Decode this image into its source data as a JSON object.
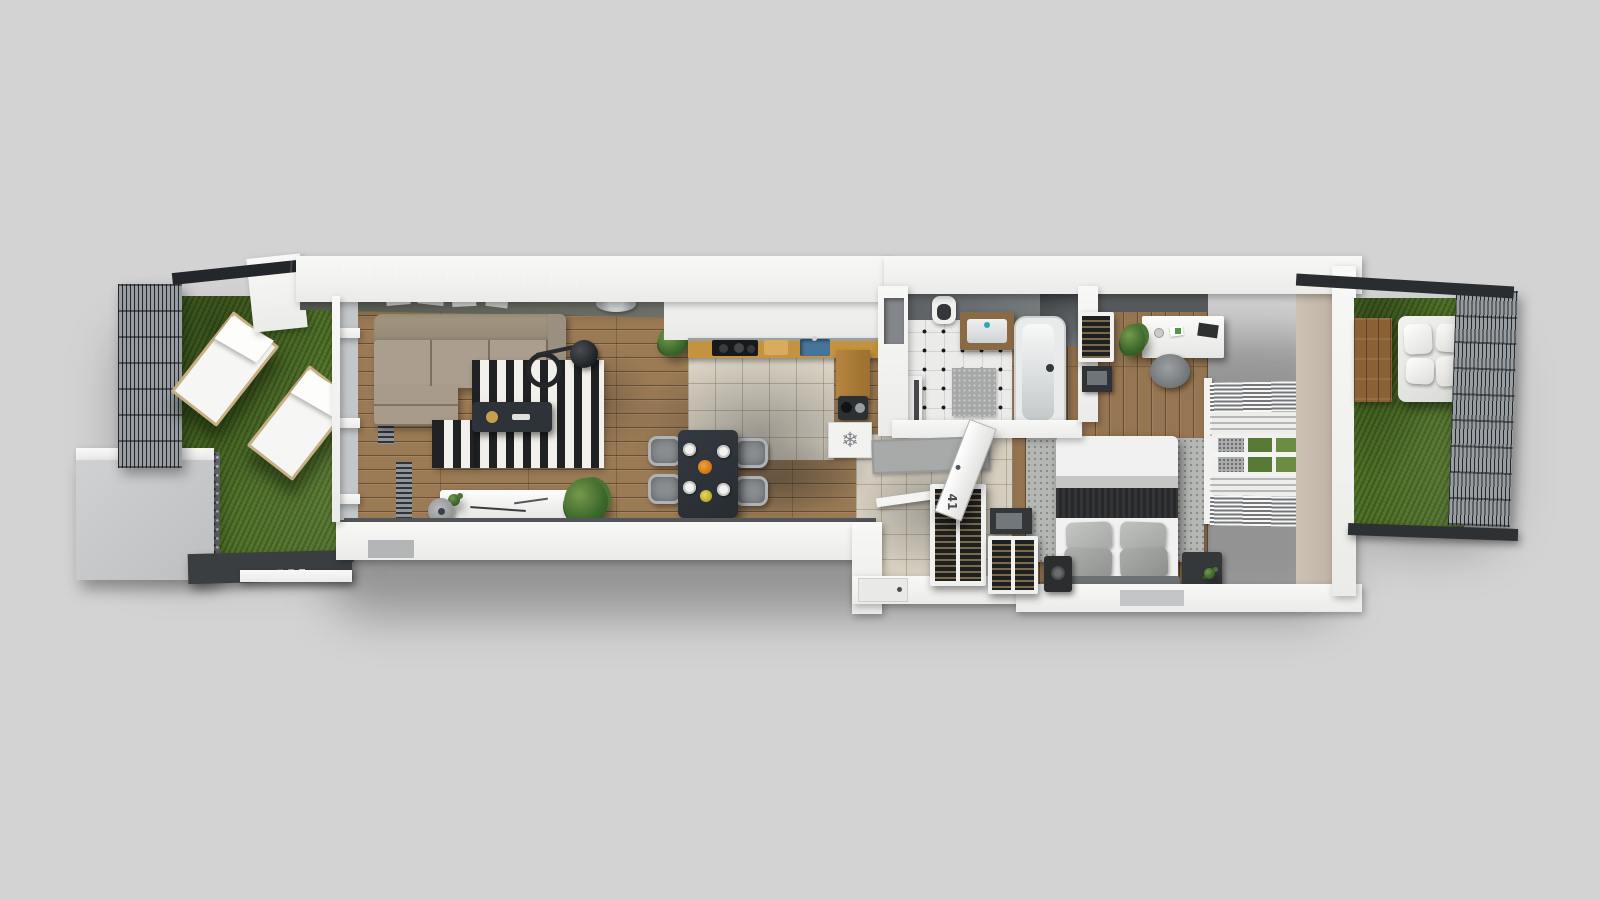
{
  "scene": {
    "type": "3d-apartment-floor-plan-render",
    "door_number": "41",
    "background": "#d3d3d3"
  },
  "icons": {
    "freezer_glyph": "❄",
    "freezer_name": "snowflake-icon"
  },
  "colors": {
    "bg": "#d3d3d3",
    "wall": "#f5f5f4",
    "wood": "#9b7b55",
    "tile_kitchen": "#ddd6c7",
    "tile_hall": "#d6cfc0",
    "tile_bath": "#ebebea",
    "grass": "#4e6f28",
    "rug_black": "#1f2123",
    "rug_white": "#f2f0ea",
    "counter_wood": "#c3933f",
    "sink_blue": "#46759b",
    "table": "#2f353b",
    "chair": "#8b8f92",
    "throw": "#26282a",
    "tan": "#c8bcae",
    "plant": "#3f6b2d",
    "accent_teal": "#2fa6b0",
    "walkway": "#3a3e41"
  },
  "rooms": {
    "left_terrace": {
      "name": "left terrace",
      "features": [
        "grass lawn",
        "two sun loungers",
        "slatted privacy fence",
        "gravel strip",
        "concrete pad",
        "walkway with drain grate",
        "dark canopy overhang"
      ]
    },
    "living_room": {
      "name": "living room",
      "furniture": [
        "corner sofa",
        "black and white striped rug",
        "coffee table",
        "floor lamp",
        "sideboard",
        "pouf",
        "potted plants",
        "radiators",
        "ceiling lamp",
        "wall pictures"
      ]
    },
    "kitchen": {
      "name": "kitchen and dining",
      "furniture": [
        "white cabinets",
        "oak counter with cooktop",
        "cutting board",
        "blue sink",
        "corner wood counter",
        "coffee machine",
        "freezer marked with snowflake",
        "dining table for four",
        "four gray chairs",
        "plates with food"
      ]
    },
    "bathroom": {
      "name": "bathroom",
      "furniture": [
        "wood vanity with basin",
        "toilet",
        "bathtub",
        "shower glass",
        "washing machine",
        "bath mat"
      ],
      "floor": "white tiles with black dot inlays"
    },
    "hallway": {
      "name": "entrance hall",
      "furniture": [
        "gray doormat",
        "open door numbered 41",
        "two wine racks",
        "storage box",
        "speaker"
      ]
    },
    "bedroom": {
      "name": "bedroom",
      "furniture": [
        "double bed with dark throw and gray pillows",
        "gray rug",
        "desk with chair",
        "desk plant",
        "bottle shelf rack",
        "tv cabinet",
        "nightstand",
        "window with venetian blinds"
      ]
    },
    "right_terrace": {
      "name": "right terrace",
      "features": [
        "grass lawn",
        "wood deck",
        "white outdoor lounge sofa",
        "mesh fence",
        "dark canopy beams"
      ]
    }
  }
}
